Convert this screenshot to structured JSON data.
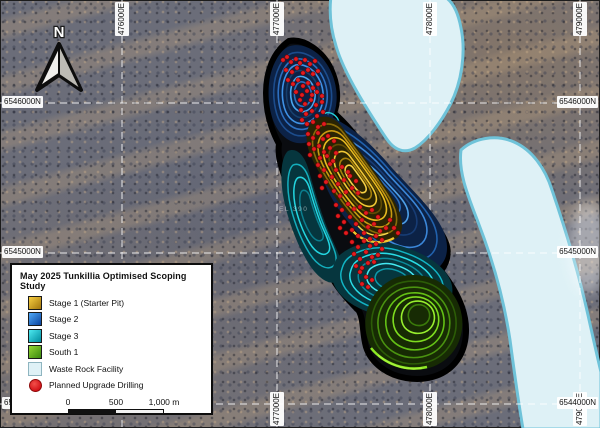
{
  "map": {
    "north_arrow": {
      "label": "N"
    },
    "faint_label": "EL 390",
    "grid": {
      "eastings": [
        {
          "label": "476000E",
          "x": 122,
          "edges": [
            "top"
          ]
        },
        {
          "label": "477000E",
          "x": 277,
          "edges": [
            "top",
            "bottom"
          ]
        },
        {
          "label": "478000E",
          "x": 430,
          "edges": [
            "top",
            "bottom"
          ]
        },
        {
          "label": "479000E",
          "x": 580,
          "edges": [
            "top",
            "bottom"
          ]
        }
      ],
      "northings": [
        {
          "label": "6546000N",
          "y": 103,
          "edges": [
            "left",
            "right"
          ]
        },
        {
          "label": "6545000N",
          "y": 253,
          "edges": [
            "left",
            "right"
          ]
        },
        {
          "label": "6544000N",
          "y": 404,
          "edges": [
            "left",
            "right"
          ]
        }
      ]
    }
  },
  "legend": {
    "title": "May 2025 Tunkillia Optimised Scoping Study",
    "items": [
      {
        "label": "Stage 1 (Starter Pit)"
      },
      {
        "label": "Stage 2"
      },
      {
        "label": "Stage 3"
      },
      {
        "label": "South 1"
      },
      {
        "label": "Waste Rock Facility"
      },
      {
        "label": "Planned Upgrade Drilling"
      }
    ],
    "scalebar": {
      "ticks": [
        "0",
        "500",
        "1,000 m"
      ]
    }
  },
  "colors": {
    "stage1": "#d9a41a",
    "stage1_dark": "#2a2403",
    "stage2": "#1f6fd0",
    "stage2_dark": "#0c2246",
    "stage3": "#17c2d0",
    "stage3_dark": "#06363e",
    "south1": "#5cb414",
    "south1_dark": "#172b04",
    "waste_fill": "#def1f6",
    "waste_border": "#6fc3d9",
    "drill": "#e41b1f",
    "grid_line": "#ffffff",
    "pit_outline": "#000000"
  },
  "drilling": {
    "points": [
      [
        283,
        60
      ],
      [
        287,
        57
      ],
      [
        291,
        62
      ],
      [
        296,
        59
      ],
      [
        300,
        63
      ],
      [
        305,
        60
      ],
      [
        310,
        64
      ],
      [
        315,
        61
      ],
      [
        286,
        70
      ],
      [
        292,
        72
      ],
      [
        297,
        68
      ],
      [
        303,
        73
      ],
      [
        308,
        70
      ],
      [
        313,
        74
      ],
      [
        318,
        71
      ],
      [
        288,
        80
      ],
      [
        293,
        84
      ],
      [
        298,
        80
      ],
      [
        303,
        86
      ],
      [
        308,
        83
      ],
      [
        313,
        88
      ],
      [
        318,
        84
      ],
      [
        296,
        92
      ],
      [
        302,
        95
      ],
      [
        307,
        91
      ],
      [
        312,
        95
      ],
      [
        317,
        92
      ],
      [
        322,
        96
      ],
      [
        300,
        100
      ],
      [
        305,
        104
      ],
      [
        311,
        100
      ],
      [
        316,
        105
      ],
      [
        322,
        102
      ],
      [
        301,
        110
      ],
      [
        306,
        114
      ],
      [
        312,
        111
      ],
      [
        317,
        116
      ],
      [
        323,
        112
      ],
      [
        302,
        120
      ],
      [
        307,
        124
      ],
      [
        313,
        122
      ],
      [
        318,
        127
      ],
      [
        324,
        124
      ],
      [
        308,
        134
      ],
      [
        313,
        138
      ],
      [
        318,
        133
      ],
      [
        323,
        139
      ],
      [
        328,
        136
      ],
      [
        334,
        141
      ],
      [
        309,
        144
      ],
      [
        314,
        149
      ],
      [
        319,
        146
      ],
      [
        324,
        152
      ],
      [
        330,
        148
      ],
      [
        336,
        153
      ],
      [
        310,
        155
      ],
      [
        320,
        158
      ],
      [
        327,
        156
      ],
      [
        333,
        161
      ],
      [
        318,
        165
      ],
      [
        324,
        170
      ],
      [
        330,
        164
      ],
      [
        336,
        170
      ],
      [
        342,
        167
      ],
      [
        348,
        172
      ],
      [
        320,
        176
      ],
      [
        326,
        182
      ],
      [
        332,
        177
      ],
      [
        338,
        184
      ],
      [
        344,
        180
      ],
      [
        350,
        176
      ],
      [
        356,
        181
      ],
      [
        322,
        188
      ],
      [
        334,
        191
      ],
      [
        340,
        196
      ],
      [
        346,
        192
      ],
      [
        352,
        188
      ],
      [
        358,
        193
      ],
      [
        336,
        205
      ],
      [
        342,
        210
      ],
      [
        348,
        204
      ],
      [
        354,
        209
      ],
      [
        360,
        207
      ],
      [
        366,
        213
      ],
      [
        372,
        210
      ],
      [
        378,
        217
      ],
      [
        338,
        216
      ],
      [
        344,
        222
      ],
      [
        350,
        217
      ],
      [
        356,
        224
      ],
      [
        362,
        220
      ],
      [
        368,
        227
      ],
      [
        374,
        224
      ],
      [
        380,
        231
      ],
      [
        386,
        228
      ],
      [
        340,
        228
      ],
      [
        346,
        233
      ],
      [
        352,
        230
      ],
      [
        358,
        236
      ],
      [
        364,
        233
      ],
      [
        370,
        239
      ],
      [
        376,
        236
      ],
      [
        382,
        240
      ],
      [
        390,
        220
      ],
      [
        394,
        228
      ],
      [
        398,
        233
      ],
      [
        352,
        242
      ],
      [
        358,
        247
      ],
      [
        364,
        241
      ],
      [
        370,
        246
      ],
      [
        376,
        244
      ],
      [
        382,
        249
      ],
      [
        354,
        254
      ],
      [
        360,
        259
      ],
      [
        366,
        252
      ],
      [
        372,
        257
      ],
      [
        378,
        255
      ],
      [
        356,
        266
      ],
      [
        362,
        268
      ],
      [
        368,
        263
      ],
      [
        374,
        262
      ],
      [
        360,
        272
      ],
      [
        366,
        277
      ],
      [
        362,
        284
      ],
      [
        368,
        287
      ],
      [
        372,
        280
      ]
    ]
  }
}
